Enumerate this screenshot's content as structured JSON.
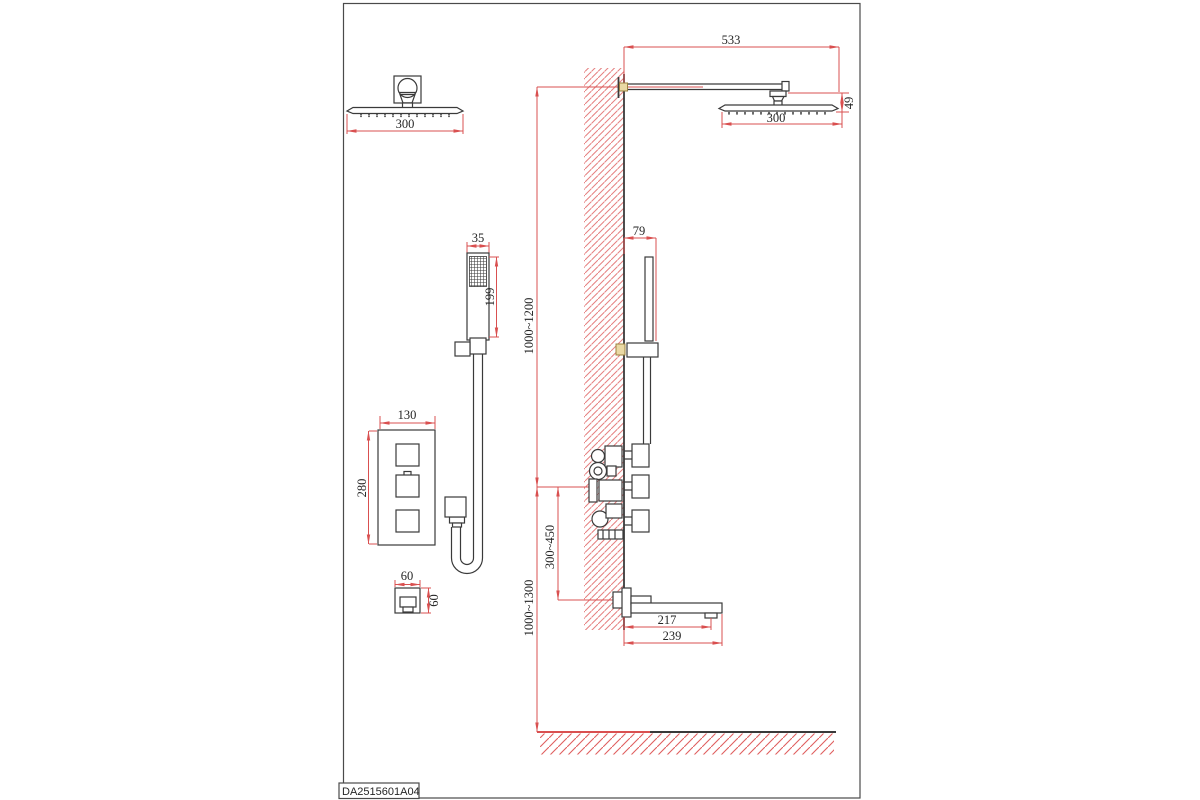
{
  "title_block": {
    "code": "DA2515601A04"
  },
  "colors": {
    "line": "#3a3a3a",
    "dimension": "#d95050",
    "wall_hatch": "#e57f7f",
    "anchor_accent": "#ead9a4"
  },
  "views": {
    "overhead_shower_front": {
      "dims": {
        "width": "300"
      }
    },
    "overhead_shower_side": {
      "dims": {
        "arm_reach": "533",
        "head_width": "300",
        "head_drop": "49"
      }
    },
    "hand_shower_front": {
      "dims": {
        "width": "35",
        "length": "199"
      }
    },
    "hand_shower_side": {
      "dims": {
        "wall_offset": "79"
      }
    },
    "mixer_front": {
      "dims": {
        "width": "130",
        "height": "280"
      }
    },
    "hose_outlet_front": {
      "dims": {
        "width": "60",
        "height": "60"
      }
    },
    "spout_side": {
      "dims": {
        "outlet_reach": "217",
        "total_reach": "239"
      }
    },
    "installation": {
      "dims": {
        "mixer_to_head": "1000~1200",
        "mixer_to_spout": "300~450",
        "floor_to_mixer": "1000~1300"
      }
    }
  }
}
